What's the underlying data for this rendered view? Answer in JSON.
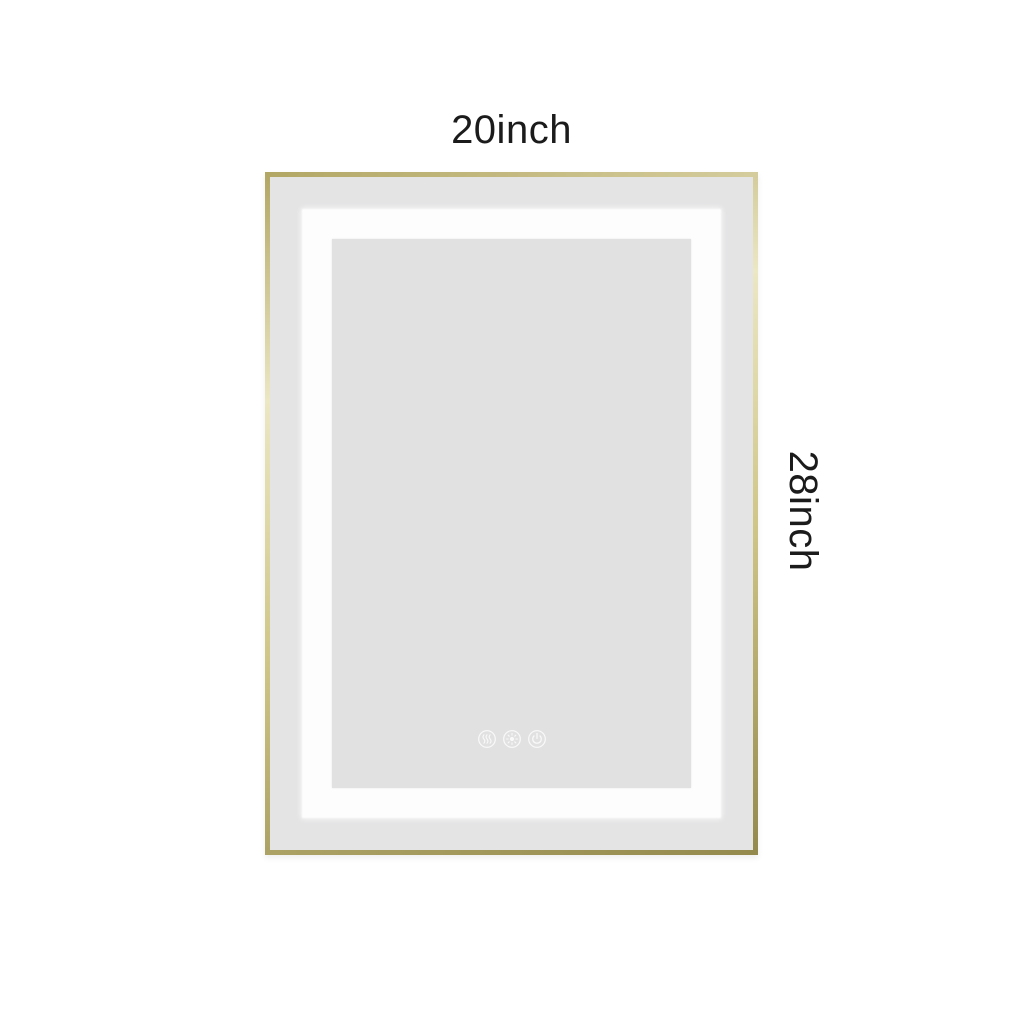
{
  "page": {
    "background_color": "#ffffff",
    "text_color": "#1b1b1b"
  },
  "labels": {
    "width": "20inch",
    "height": "28inch"
  },
  "mirror": {
    "frame_color_base": "#b3a765",
    "frame_color_highlight": "#ece7c4",
    "frame_color_mid": "#cfc586",
    "frame_color_dark": "#958a4e",
    "outer_surface_color": "#e4e4e5",
    "led_band_color": "#fdfdfd",
    "inner_surface_color": "#e1e1e2",
    "touch_controls": [
      {
        "icon": "defog-icon"
      },
      {
        "icon": "brightness-icon"
      },
      {
        "icon": "power-icon"
      }
    ]
  }
}
